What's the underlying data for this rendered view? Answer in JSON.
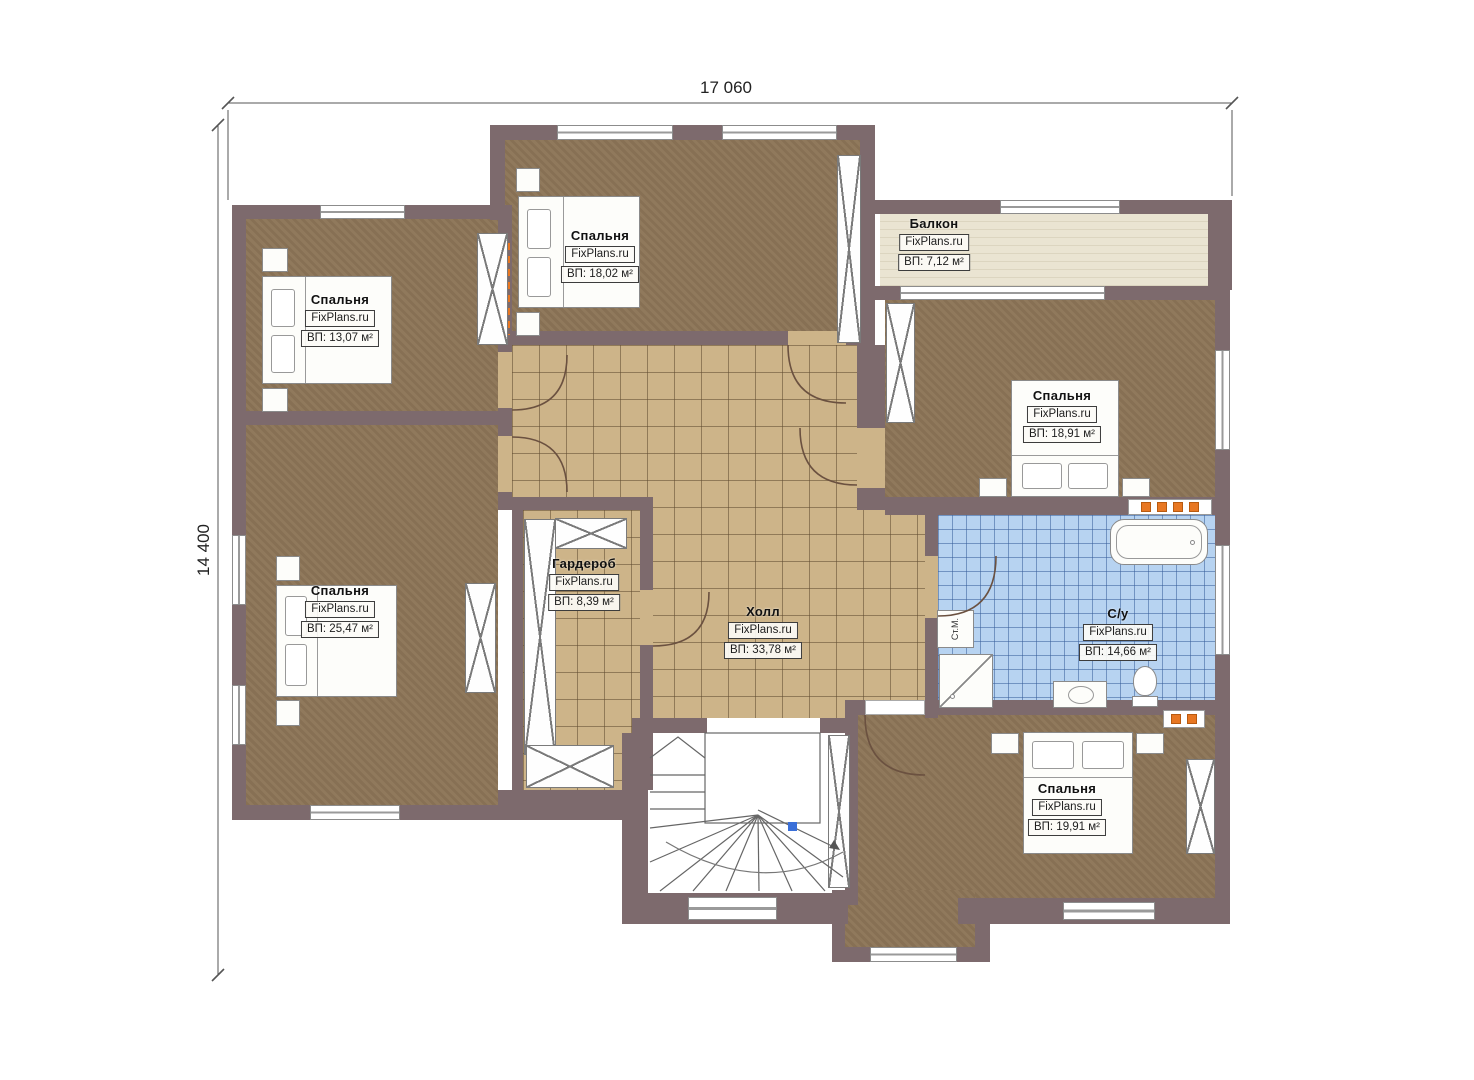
{
  "dimensions": {
    "width": "17 060",
    "height": "14 400"
  },
  "watermark": "FixPlans.ru",
  "rooms": [
    {
      "name": "Спальня",
      "site": "FixPlans.ru",
      "area": "ВП: 18,02 м²"
    },
    {
      "name": "Спальня",
      "site": "FixPlans.ru",
      "area": "ВП: 13,07 м²"
    },
    {
      "name": "Балкон",
      "site": "FixPlans.ru",
      "area": "ВП: 7,12 м²"
    },
    {
      "name": "Спальня",
      "site": "FixPlans.ru",
      "area": "ВП: 18,91 м²"
    },
    {
      "name": "Спальня",
      "site": "FixPlans.ru",
      "area": "ВП: 25,47 м²"
    },
    {
      "name": "Гардероб",
      "site": "FixPlans.ru",
      "area": "ВП: 8,39 м²"
    },
    {
      "name": "Холл",
      "site": "FixPlans.ru",
      "area": "ВП: 33,78 м²"
    },
    {
      "name": "С/у",
      "site": "FixPlans.ru",
      "area": "ВП: 14,66 м²"
    },
    {
      "name": "Спальня",
      "site": "FixPlans.ru",
      "area": "ВП: 19,91 м²"
    }
  ],
  "fixtures": {
    "washing_machine_label": "Ст.М."
  },
  "colors": {
    "wall": "#7d6a6d",
    "bedroom_floor": "#8c7557",
    "tile_floor": "#cdb489",
    "bath_floor": "#b7d3f1",
    "balcony_floor": "#eae4d2",
    "accent_orange": "#e87722"
  }
}
